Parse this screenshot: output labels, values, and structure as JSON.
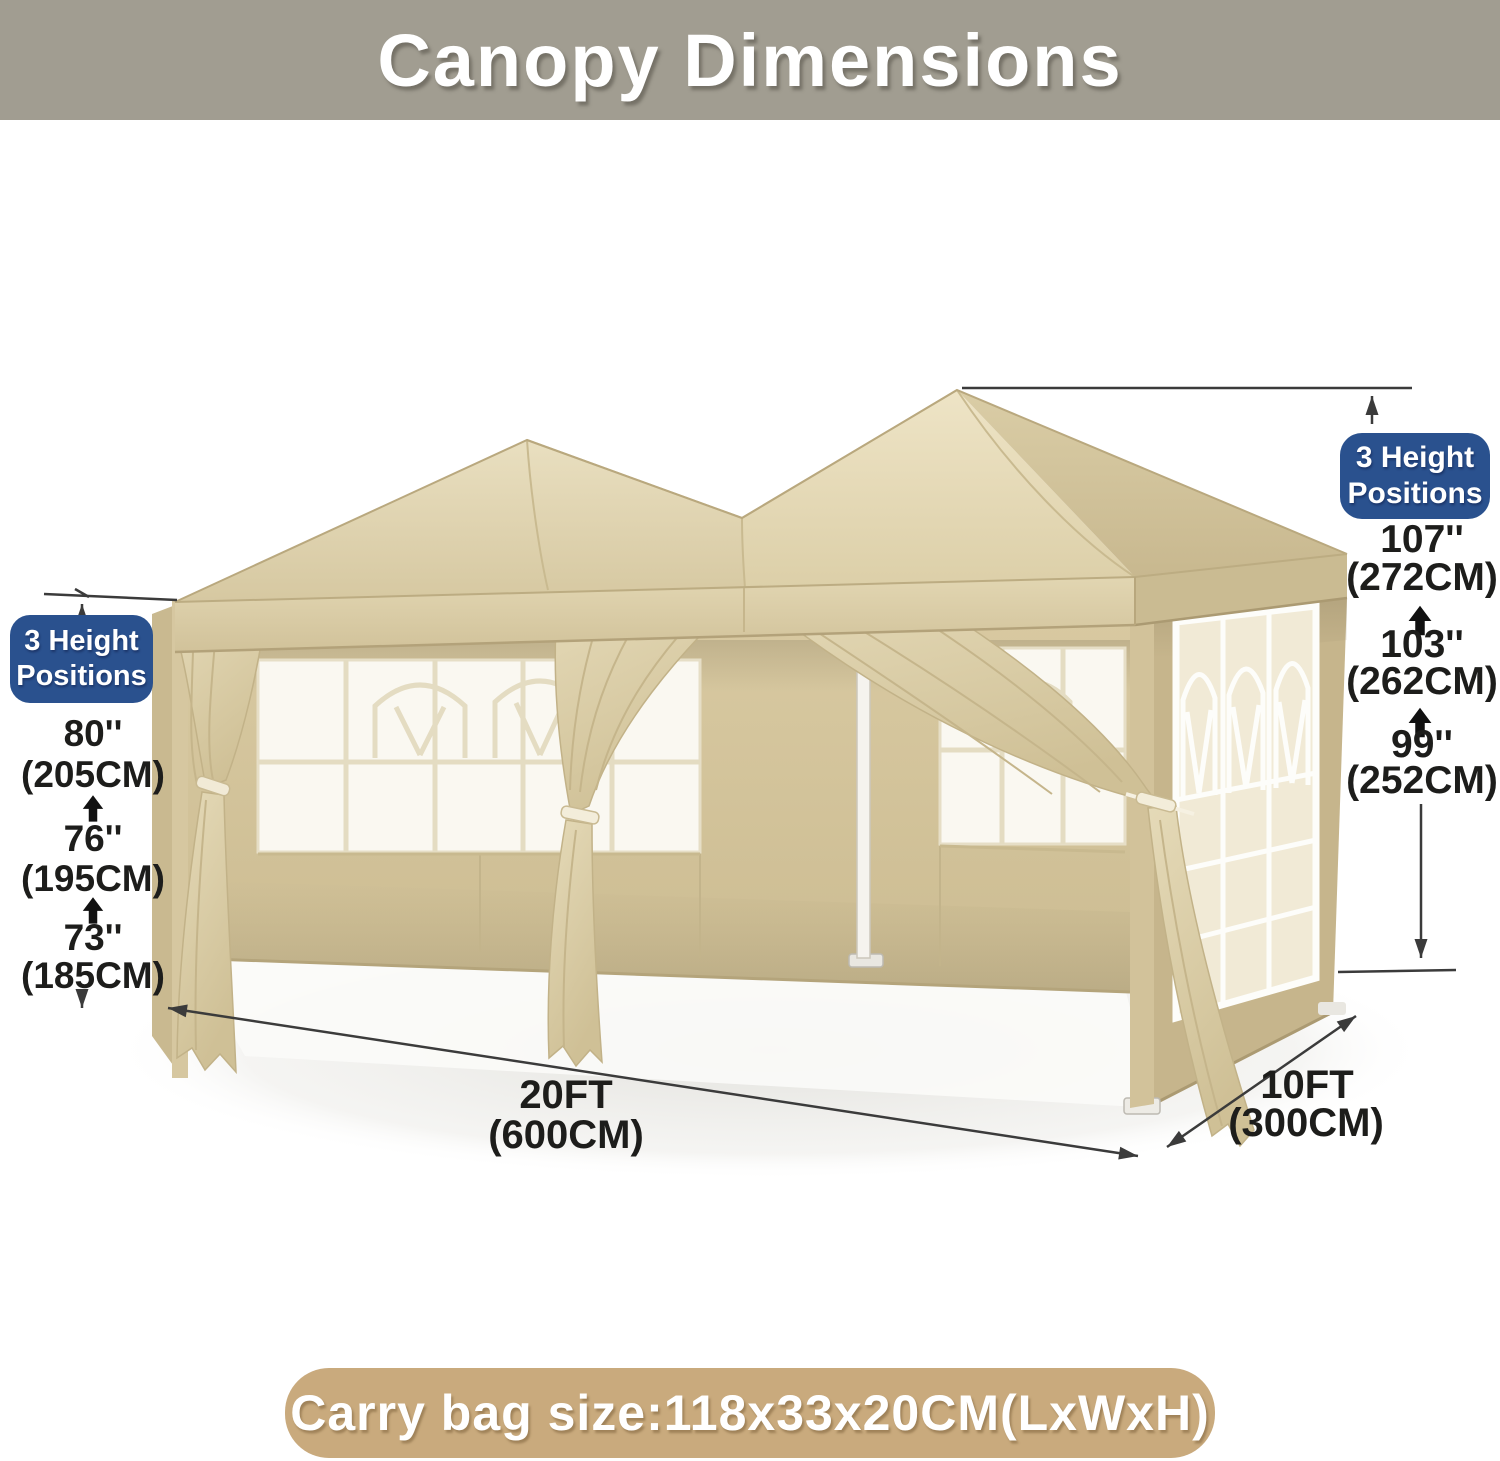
{
  "title": "Canopy Dimensions",
  "colors": {
    "titlebar_bg": "#a19d91",
    "badge_bg": "#2a518e",
    "banner_bg": "#c9aa7d",
    "canopy_beige": "#ddd2ae",
    "sidewall_tan": "#c6b58c",
    "dimension_line": "#3b3b3b"
  },
  "badge_left": {
    "line1": "3 Height",
    "line2": "Positions"
  },
  "badge_right": {
    "line1": "3 Height",
    "line2": "Positions"
  },
  "left_heights": [
    {
      "in": "80''",
      "cm": "(205CM)"
    },
    {
      "in": "76''",
      "cm": "(195CM)"
    },
    {
      "in": "73''",
      "cm": "(185CM)"
    }
  ],
  "right_heights": [
    {
      "in": "107''",
      "cm": "(272CM)"
    },
    {
      "in": "103''",
      "cm": "(262CM)"
    },
    {
      "in": "99''",
      "cm": "(252CM)"
    }
  ],
  "footprint": {
    "length_ft": "20FT",
    "length_cm": "(600CM)",
    "width_ft": "10FT",
    "width_cm": "(300CM)"
  },
  "carry_bag": "Carry bag size:118x33x20CM(LxWxH)"
}
